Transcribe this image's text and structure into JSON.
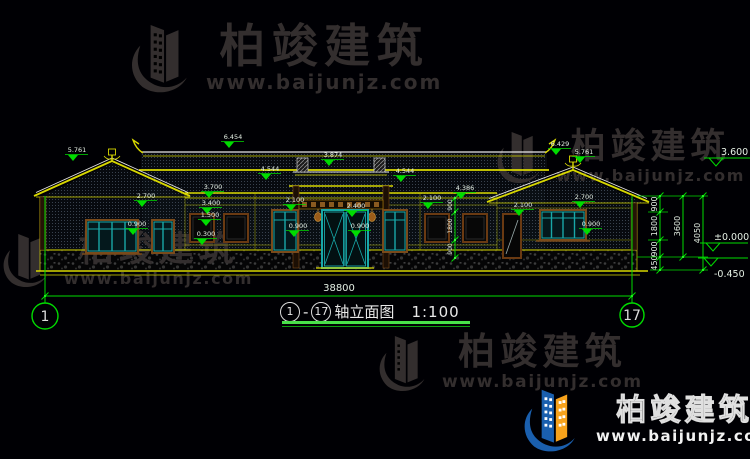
{
  "watermark": {
    "brand": "柏竣建筑",
    "url": "www.baijunjz.com"
  },
  "caption": {
    "axis_from": "1",
    "dash": "-",
    "axis_to": "17",
    "title": "轴立面图",
    "scale": "1:100"
  },
  "colors": {
    "background": "#000004",
    "cad_yellow": "#d8d800",
    "cad_white": "#e8e8e8",
    "dim_green": "#00dc00",
    "window_teal": "#18a8a8",
    "frame_brown": "#7a4a1a",
    "watermark_gray": "#332e2e",
    "logo_blue": "#1a5fae",
    "logo_orange": "#f7a21b"
  },
  "drawing": {
    "elevation_tags": [
      {
        "x": 77,
        "y": 152,
        "v": "5.761"
      },
      {
        "x": 233,
        "y": 139,
        "v": "6.454"
      },
      {
        "x": 270,
        "y": 171,
        "v": "4.544"
      },
      {
        "x": 405,
        "y": 173,
        "v": "4.544"
      },
      {
        "x": 333,
        "y": 157,
        "v": "3.874"
      },
      {
        "x": 213,
        "y": 189,
        "v": "3.700"
      },
      {
        "x": 211,
        "y": 205,
        "v": "3.400"
      },
      {
        "x": 210,
        "y": 217,
        "v": "1.500"
      },
      {
        "x": 206,
        "y": 236,
        "v": "0.300"
      },
      {
        "x": 146,
        "y": 198,
        "v": "2.700"
      },
      {
        "x": 137,
        "y": 226,
        "v": "0.900"
      },
      {
        "x": 295,
        "y": 202,
        "v": "2.100"
      },
      {
        "x": 298,
        "y": 228,
        "v": "0.900"
      },
      {
        "x": 356,
        "y": 208,
        "v": "2.400"
      },
      {
        "x": 360,
        "y": 228,
        "v": "0.900"
      },
      {
        "x": 432,
        "y": 200,
        "v": "2.100"
      },
      {
        "x": 465,
        "y": 190,
        "v": "4.386"
      },
      {
        "x": 560,
        "y": 146,
        "v": "6.429"
      },
      {
        "x": 584,
        "y": 154,
        "v": "5.761"
      },
      {
        "x": 523,
        "y": 207,
        "v": "2.100"
      },
      {
        "x": 584,
        "y": 199,
        "v": "2.700"
      },
      {
        "x": 591,
        "y": 226,
        "v": "0.900"
      }
    ],
    "level_marks": [
      {
        "v": "3.600",
        "tx": 721,
        "ty": 155,
        "lx": 704,
        "lw": 46,
        "ly": 158,
        "ax": 716
      },
      {
        "v": "±0.000",
        "tx": 714,
        "ty": 240,
        "lx": 700,
        "lw": 48,
        "ly": 243,
        "ax": 713
      },
      {
        "v": "-0.450",
        "tx": 714,
        "ty": 277,
        "lx": 698,
        "lw": 50,
        "ly": 258,
        "ax": 711
      }
    ],
    "chains": [
      {
        "x": 660,
        "y1": 196,
        "y2": 270,
        "ticks": [
          196,
          212,
          240,
          257,
          270
        ],
        "fs": 8,
        "labels": [
          {
            "y": 204,
            "v": "900"
          },
          {
            "y": 226,
            "v": "1800"
          },
          {
            "y": 249,
            "v": "900"
          },
          {
            "y": 263,
            "v": "450"
          }
        ]
      },
      {
        "x": 683,
        "y1": 196,
        "y2": 257,
        "ticks": [
          196,
          257
        ],
        "fs": 8,
        "labels": [
          {
            "y": 226,
            "v": "3600"
          }
        ]
      },
      {
        "x": 703,
        "y1": 196,
        "y2": 270,
        "ticks": [
          196,
          270
        ],
        "fs": 8,
        "labels": [
          {
            "y": 233,
            "v": "4050"
          }
        ]
      },
      {
        "x": 455,
        "y1": 198,
        "y2": 258,
        "ticks": [
          198,
          212,
          240,
          258
        ],
        "fs": 6,
        "labels": [
          {
            "y": 205,
            "v": "900"
          },
          {
            "y": 226,
            "v": "1800"
          },
          {
            "y": 249,
            "v": "900"
          }
        ]
      }
    ],
    "ext_lines": [
      {
        "x1": 637,
        "y1": 196,
        "x2": 708,
        "y2": 196
      },
      {
        "x1": 637,
        "y1": 257,
        "x2": 708,
        "y2": 257
      },
      {
        "x1": 648,
        "y1": 212,
        "x2": 668,
        "y2": 212
      },
      {
        "x1": 648,
        "y1": 240,
        "x2": 668,
        "y2": 240
      },
      {
        "x1": 650,
        "y1": 270,
        "x2": 708,
        "y2": 270
      }
    ],
    "overall_dim": {
      "v": "38800",
      "y": 296,
      "x1": 45,
      "x2": 632,
      "tx": 339,
      "ty": 291
    },
    "axes": [
      {
        "x": 45,
        "y": 316,
        "r": 13,
        "label": "1",
        "ly1": 196,
        "ly2": 303
      },
      {
        "x": 632,
        "y": 315,
        "r": 12,
        "label": "17",
        "ly1": 196,
        "ly2": 303
      }
    ]
  }
}
